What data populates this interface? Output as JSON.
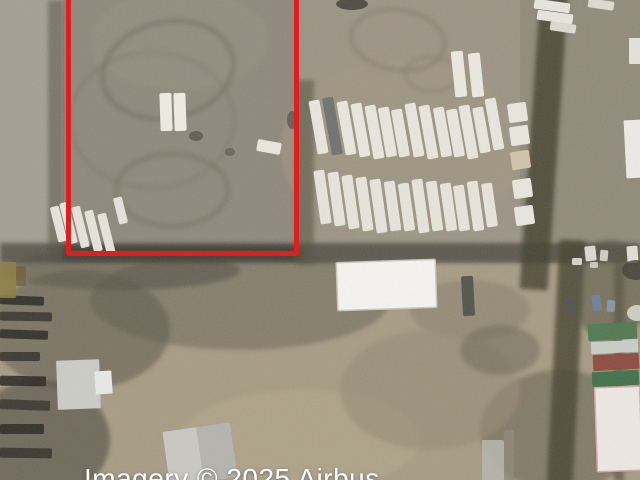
{
  "map": {
    "kind": "satellite-aerial-imagery",
    "subject": "dirt industrial lots with parked semi-trailers, warehouse roofs and container stacks"
  },
  "attribution": {
    "text": "Imagery © 2025 Airbus",
    "color": "#ffffff",
    "x": 84,
    "y": 463,
    "font_px": 28
  },
  "annotation": {
    "shape": "rectangle",
    "color": "#e01e1e",
    "stroke_px": 5,
    "left": 66,
    "top": -14,
    "width": 233,
    "height": 270
  },
  "scene": {
    "layers": [
      {
        "t": "rect",
        "x": 0,
        "y": 0,
        "w": 640,
        "h": 480,
        "c": "#978f7e",
        "name": "dirt-ground"
      },
      {
        "t": "rect",
        "x": 0,
        "y": 0,
        "w": 66,
        "h": 263,
        "c": "#a39e92",
        "name": "left-lot-dirt"
      },
      {
        "t": "rect",
        "x": 63,
        "y": 0,
        "w": 240,
        "h": 263,
        "c": "#8d887a",
        "name": "parcel-dirt"
      },
      {
        "t": "rect",
        "x": 299,
        "y": 0,
        "w": 341,
        "h": 263,
        "c": "#9c9384",
        "name": "trailer-lot-dirt"
      },
      {
        "t": "rect",
        "x": 520,
        "y": 0,
        "w": 120,
        "h": 263,
        "c": "#8f8878",
        "o": 0.8,
        "name": "far-right-dirt"
      },
      {
        "t": "rect",
        "x": 0,
        "y": 263,
        "w": 640,
        "h": 217,
        "c": "#a79b83",
        "name": "south-lot-dirt"
      },
      {
        "t": "ell",
        "cx": 180,
        "cy": 40,
        "rx": 90,
        "ry": 50,
        "c": "#948e7f",
        "o": 0.8,
        "blur": 1,
        "name": "dirt-shade"
      },
      {
        "t": "ell",
        "cx": 400,
        "cy": 150,
        "rx": 120,
        "ry": 90,
        "c": "#a1987f",
        "o": 0.5,
        "blur": 1,
        "name": "dirt-shade"
      },
      {
        "t": "ell",
        "cx": 240,
        "cy": 300,
        "rx": 150,
        "ry": 50,
        "c": "#6f6a5b",
        "o": 0.6,
        "blur": 1,
        "name": "dark-ground-mottle"
      },
      {
        "t": "ell",
        "cx": 120,
        "cy": 270,
        "rx": 120,
        "ry": 20,
        "c": "#4a463c",
        "o": 0.5,
        "blur": 1,
        "name": "dark-ground-mottle"
      },
      {
        "t": "ell",
        "cx": 470,
        "cy": 310,
        "rx": 60,
        "ry": 30,
        "c": "#837c6b",
        "o": 0.5,
        "blur": 1,
        "name": "dirt-shade"
      },
      {
        "t": "ell",
        "cx": 560,
        "cy": 430,
        "rx": 80,
        "ry": 60,
        "c": "#5e5a4c",
        "o": 0.5,
        "blur": 1,
        "name": "vegetation-patch"
      },
      {
        "t": "ell",
        "cx": 80,
        "cy": 330,
        "rx": 90,
        "ry": 60,
        "c": "#5a5649",
        "o": 0.55,
        "blur": 1,
        "name": "dark-ground-mottle"
      },
      {
        "t": "ell",
        "cx": 40,
        "cy": 440,
        "rx": 70,
        "ry": 60,
        "c": "#4e4a40",
        "o": 0.6,
        "blur": 1,
        "name": "dark-ground-mottle"
      },
      {
        "t": "ell",
        "cx": 300,
        "cy": 440,
        "rx": 120,
        "ry": 50,
        "c": "#b3a78c",
        "o": 0.6,
        "blur": 1,
        "name": "light-dirt-patch"
      },
      {
        "t": "ell",
        "cx": 430,
        "cy": 390,
        "rx": 90,
        "ry": 60,
        "c": "#968b75",
        "o": 0.6,
        "blur": 1,
        "name": "dirt-shade"
      },
      {
        "t": "ellstroke",
        "cx": 168,
        "cy": 70,
        "rx": 66,
        "ry": 48,
        "sw": 5,
        "c": "#746e60",
        "o": 0.6,
        "r": -12,
        "blur": 1,
        "name": "tire-track-circle"
      },
      {
        "t": "ellstroke",
        "cx": 152,
        "cy": 120,
        "rx": 82,
        "ry": 68,
        "sw": 4,
        "c": "#7a7466",
        "o": 0.4,
        "blur": 1,
        "name": "tire-track-circle"
      },
      {
        "t": "ellstroke",
        "cx": 172,
        "cy": 190,
        "rx": 56,
        "ry": 36,
        "sw": 5,
        "c": "#6f6a5c",
        "o": 0.45,
        "blur": 1,
        "name": "tire-track-circle"
      },
      {
        "t": "ellstroke",
        "cx": 398,
        "cy": 40,
        "rx": 47,
        "ry": 30,
        "sw": 5,
        "c": "#857d6d",
        "o": 0.55,
        "r": 8,
        "blur": 1,
        "name": "tire-track-circle"
      },
      {
        "t": "ellstroke",
        "cx": 432,
        "cy": 74,
        "rx": 27,
        "ry": 17,
        "sw": 4,
        "c": "#857d6d",
        "o": 0.45,
        "blur": 1,
        "name": "tire-track-circle"
      },
      {
        "t": "ell",
        "cx": 196,
        "cy": 136,
        "rx": 7,
        "ry": 5,
        "c": "#57534a",
        "o": 0.8,
        "name": "ground-debris"
      },
      {
        "t": "ell",
        "cx": 230,
        "cy": 152,
        "rx": 5,
        "ry": 4,
        "c": "#5d5950",
        "o": 0.7,
        "name": "ground-debris"
      },
      {
        "t": "ell",
        "cx": 292,
        "cy": 120,
        "rx": 5,
        "ry": 9,
        "c": "#4f4c44",
        "o": 0.7,
        "name": "ground-debris"
      },
      {
        "t": "ell",
        "cx": 352,
        "cy": 4,
        "rx": 16,
        "ry": 6,
        "c": "#3a382f",
        "o": 0.8,
        "name": "ground-debris"
      },
      {
        "t": "rect",
        "x": 48,
        "y": 0,
        "w": 16,
        "h": 263,
        "c": "#6c675a",
        "o": 0.75,
        "blur": 1,
        "name": "vegetation-strip"
      },
      {
        "t": "rect",
        "x": 0,
        "y": 243,
        "w": 640,
        "h": 20,
        "c": "#4d4a40",
        "o": 0.8,
        "blur": 1,
        "name": "vegetation-strip"
      },
      {
        "t": "rect",
        "x": 63,
        "y": 246,
        "w": 240,
        "h": 14,
        "c": "#3c3a31",
        "o": 0.85,
        "blur": 1,
        "name": "vegetation-strip"
      },
      {
        "t": "rect",
        "x": 296,
        "y": 80,
        "w": 18,
        "h": 185,
        "c": "#56523f",
        "o": 0.6,
        "blur": 1,
        "name": "vegetation-strip"
      },
      {
        "t": "rect",
        "x": 530,
        "y": -10,
        "w": 28,
        "h": 300,
        "c": "#43402f",
        "o": 0.8,
        "r": 4,
        "blur": 1,
        "name": "vegetation-strip"
      },
      {
        "t": "rect",
        "x": 553,
        "y": 240,
        "w": 26,
        "h": 250,
        "c": "#45422f",
        "o": 0.8,
        "r": 3,
        "blur": 1,
        "name": "vegetation-strip"
      },
      {
        "t": "rect",
        "x": 614,
        "y": 262,
        "w": 10,
        "h": 220,
        "c": "#4a4738",
        "o": 0.6,
        "blur": 1,
        "name": "vegetation-strip"
      },
      {
        "t": "rect",
        "x": 0,
        "y": 296,
        "w": 44,
        "h": 9,
        "c": "#2c2a24",
        "o": 0.9,
        "r": 2,
        "name": "stacked-material-row"
      },
      {
        "t": "rect",
        "x": 0,
        "y": 312,
        "w": 52,
        "h": 9,
        "c": "#33312a",
        "o": 0.85,
        "r": 1,
        "name": "stacked-material-row"
      },
      {
        "t": "rect",
        "x": 0,
        "y": 330,
        "w": 48,
        "h": 9,
        "c": "#2c2a24",
        "o": 0.9,
        "r": 2,
        "name": "stacked-material-row"
      },
      {
        "t": "rect",
        "x": 0,
        "y": 352,
        "w": 40,
        "h": 9,
        "c": "#302e27",
        "o": 0.85,
        "name": "stacked-material-row"
      },
      {
        "t": "rect",
        "x": 0,
        "y": 376,
        "w": 46,
        "h": 10,
        "c": "#2a2822",
        "o": 0.9,
        "r": 1,
        "name": "stacked-material-row"
      },
      {
        "t": "rect",
        "x": 0,
        "y": 400,
        "w": 50,
        "h": 10,
        "c": "#34322b",
        "o": 0.85,
        "r": 2,
        "name": "stacked-material-row"
      },
      {
        "t": "rect",
        "x": 0,
        "y": 424,
        "w": 44,
        "h": 10,
        "c": "#2b2923",
        "o": 0.9,
        "name": "stacked-material-row"
      },
      {
        "t": "rect",
        "x": 0,
        "y": 448,
        "w": 52,
        "h": 10,
        "c": "#312f28",
        "o": 0.85,
        "r": 1,
        "name": "stacked-material-row"
      },
      {
        "t": "rect",
        "x": 0,
        "y": 262,
        "w": 16,
        "h": 36,
        "c": "#8d7a43",
        "o": 0.9,
        "name": "yellow-equipment"
      },
      {
        "t": "rect",
        "x": 16,
        "y": 266,
        "w": 10,
        "h": 20,
        "c": "#6d5c33",
        "o": 0.8,
        "name": "yellow-equipment"
      },
      {
        "t": "ell",
        "cx": 500,
        "cy": 350,
        "rx": 40,
        "ry": 25,
        "c": "#6b6557",
        "o": 0.5,
        "blur": 1,
        "name": "dark-ground-mottle"
      },
      {
        "t": "rect",
        "x": 482,
        "y": 440,
        "w": 22,
        "h": 40,
        "c": "#b7b5ac",
        "o": 0.9,
        "name": "light-paved-strip"
      },
      {
        "t": "rect",
        "x": 504,
        "y": 430,
        "w": 10,
        "h": 50,
        "c": "#8e897b",
        "o": 0.7,
        "name": "light-paved-strip"
      },
      {
        "t": "ell",
        "cx": 610,
        "cy": 290,
        "rx": 40,
        "ry": 50,
        "c": "#54513f",
        "o": 0.55,
        "blur": 1,
        "name": "vegetation-patch"
      },
      {
        "t": "rect",
        "x": 585,
        "y": 246,
        "w": 11,
        "h": 15,
        "c": "#dcdad0",
        "r": -6,
        "name": "small-truck"
      },
      {
        "t": "rect",
        "x": 600,
        "y": 250,
        "w": 8,
        "h": 11,
        "c": "#cfcdc3",
        "r": 5,
        "name": "small-truck"
      },
      {
        "t": "rect",
        "x": 627,
        "y": 246,
        "w": 11,
        "h": 17,
        "c": "#e2e0d6",
        "r": -4,
        "name": "small-truck"
      },
      {
        "t": "rect",
        "x": 592,
        "y": 295,
        "w": 9,
        "h": 16,
        "c": "#6d8097",
        "r": -5,
        "name": "blue-truck"
      },
      {
        "t": "rect",
        "x": 607,
        "y": 300,
        "w": 8,
        "h": 12,
        "c": "#8795a3",
        "r": 4,
        "name": "blue-truck"
      },
      {
        "t": "rect",
        "x": 567,
        "y": 300,
        "w": 8,
        "h": 16,
        "c": "#50524e",
        "r": -8,
        "name": "dark-vehicle"
      },
      {
        "t": "ell",
        "cx": 637,
        "cy": 313,
        "rx": 10,
        "ry": 8,
        "c": "#d8d6cc",
        "o": 0.9,
        "name": "small-truck"
      },
      {
        "t": "rect",
        "x": 622,
        "y": 338,
        "w": 16,
        "h": 10,
        "c": "#c7c5bb",
        "r": 3,
        "name": "small-truck"
      },
      {
        "t": "ell",
        "cx": 636,
        "cy": 270,
        "rx": 14,
        "ry": 10,
        "c": "#3f3d33",
        "o": 0.8,
        "name": "dark-vehicle"
      },
      {
        "t": "rect",
        "x": 572,
        "y": 258,
        "w": 10,
        "h": 7,
        "c": "#d5d3c9",
        "name": "small-truck"
      },
      {
        "t": "rect",
        "x": 590,
        "y": 262,
        "w": 8,
        "h": 6,
        "c": "#cac8be",
        "name": "small-truck"
      },
      {
        "t": "ell",
        "cx": 630,
        "cy": 430,
        "rx": 18,
        "ry": 40,
        "c": "#4c4a3c",
        "o": 0.5,
        "blur": 1,
        "name": "vegetation-patch"
      }
    ],
    "trailer_groups": [
      {
        "name": "trailer",
        "w": 11,
        "h": 54,
        "r": -10,
        "c": "#e9e7de",
        "items": [
          [
            313,
            100
          ],
          [
            327,
            97,
            58,
            "#6f716c"
          ],
          [
            341,
            101
          ],
          [
            355,
            103
          ],
          [
            369,
            105
          ],
          [
            382,
            107,
            50
          ],
          [
            395,
            109,
            48
          ],
          [
            409,
            103
          ],
          [
            423,
            105
          ],
          [
            437,
            107,
            50
          ],
          [
            450,
            109,
            48
          ],
          [
            463,
            105
          ],
          [
            476,
            107,
            46
          ],
          [
            489,
            98,
            52
          ]
        ]
      },
      {
        "name": "trailer",
        "w": 11,
        "h": 54,
        "r": -8,
        "c": "#e7e5dc",
        "items": [
          [
            317,
            170
          ],
          [
            331,
            172
          ],
          [
            345,
            175
          ],
          [
            359,
            177
          ],
          [
            373,
            179
          ],
          [
            387,
            181,
            50
          ],
          [
            401,
            183,
            48
          ],
          [
            415,
            179
          ],
          [
            429,
            181,
            50
          ],
          [
            443,
            183,
            48
          ],
          [
            456,
            185,
            46
          ],
          [
            470,
            181,
            50
          ],
          [
            484,
            183,
            44
          ]
        ]
      },
      {
        "name": "trailer",
        "w": 12,
        "h": 46,
        "r": -6,
        "c": "#eceae1",
        "items": [
          [
            453,
            51
          ],
          [
            470,
            53,
            44
          ]
        ]
      },
      {
        "name": "trailer",
        "w": 36,
        "h": 10,
        "r": 8,
        "c": "#e8e6dd",
        "items": [
          [
            534,
            1
          ],
          [
            537,
            12
          ]
        ]
      },
      {
        "name": "trailer",
        "w": 26,
        "h": 9,
        "r": 8,
        "c": "#dddbd1",
        "items": [
          [
            550,
            23
          ],
          [
            588,
            0
          ]
        ]
      },
      {
        "name": "box-truck",
        "w": 19,
        "h": 19,
        "r": -8,
        "c": "#e9e7de",
        "items": [
          [
            508,
            103
          ],
          [
            510,
            126
          ],
          [
            511,
            151,
            18,
            "#cfc5ab"
          ],
          [
            513,
            179
          ],
          [
            515,
            206
          ]
        ]
      },
      {
        "name": "trailer",
        "w": 12,
        "h": 38,
        "r": -2,
        "c": "#efede5",
        "items": [
          [
            160,
            93
          ],
          [
            174,
            93
          ]
        ]
      },
      {
        "name": "trailer",
        "w": 24,
        "h": 12,
        "r": 10,
        "c": "#e9e7de",
        "items": [
          [
            257,
            141
          ]
        ]
      },
      {
        "name": "trailer",
        "w": 9,
        "h": 42,
        "r": -14,
        "c": "#e6e4db",
        "items": [
          [
            64,
            202
          ],
          [
            76,
            206
          ],
          [
            89,
            210
          ],
          [
            102,
            213
          ],
          [
            116,
            197,
            27
          ],
          [
            54,
            206,
            36
          ]
        ]
      },
      {
        "name": "dark-trailer",
        "w": 12,
        "h": 40,
        "r": -3,
        "c": "#53534c",
        "items": [
          [
            462,
            276
          ]
        ]
      }
    ],
    "buildings": [
      {
        "x": 337,
        "y": 261,
        "w": 99,
        "h": 48,
        "c": "#f6f5f1",
        "r": -2,
        "edge": "#c9c7bf",
        "name": "warehouse-roof"
      },
      {
        "x": 57,
        "y": 360,
        "w": 43,
        "h": 49,
        "c": "#ccccc7",
        "r": -2,
        "name": "gray-building-roof"
      },
      {
        "x": 95,
        "y": 371,
        "w": 17,
        "h": 23,
        "c": "#e9e9e5",
        "r": -4,
        "name": "small-white-shed"
      },
      {
        "x": 166,
        "y": 427,
        "w": 68,
        "h": 55,
        "c": "#b4b3ad",
        "r": -8,
        "ridge": 1,
        "name": "gabled-building-roof"
      },
      {
        "x": 625,
        "y": 120,
        "w": 17,
        "h": 58,
        "c": "#edece6",
        "r": -3,
        "name": "right-edge-building"
      },
      {
        "x": 629,
        "y": 38,
        "w": 12,
        "h": 26,
        "c": "#e5e3d9",
        "name": "right-edge-shed"
      },
      {
        "x": 588,
        "y": 323,
        "w": 49,
        "h": 17,
        "c": "#50784f",
        "r": -3,
        "name": "green-container"
      },
      {
        "x": 591,
        "y": 341,
        "w": 47,
        "h": 12,
        "c": "#c9cec9",
        "r": -3,
        "name": "white-container"
      },
      {
        "x": 593,
        "y": 354,
        "w": 46,
        "h": 16,
        "c": "#8c4a40",
        "r": -3,
        "name": "red-container"
      },
      {
        "x": 592,
        "y": 371,
        "w": 47,
        "h": 15,
        "c": "#41704a",
        "r": -3,
        "name": "green-container"
      },
      {
        "x": 596,
        "y": 387,
        "w": 45,
        "h": 84,
        "c": "#efe9e4",
        "r": -2,
        "edge": "#d8a8a4",
        "name": "white-tent-structure"
      }
    ]
  }
}
